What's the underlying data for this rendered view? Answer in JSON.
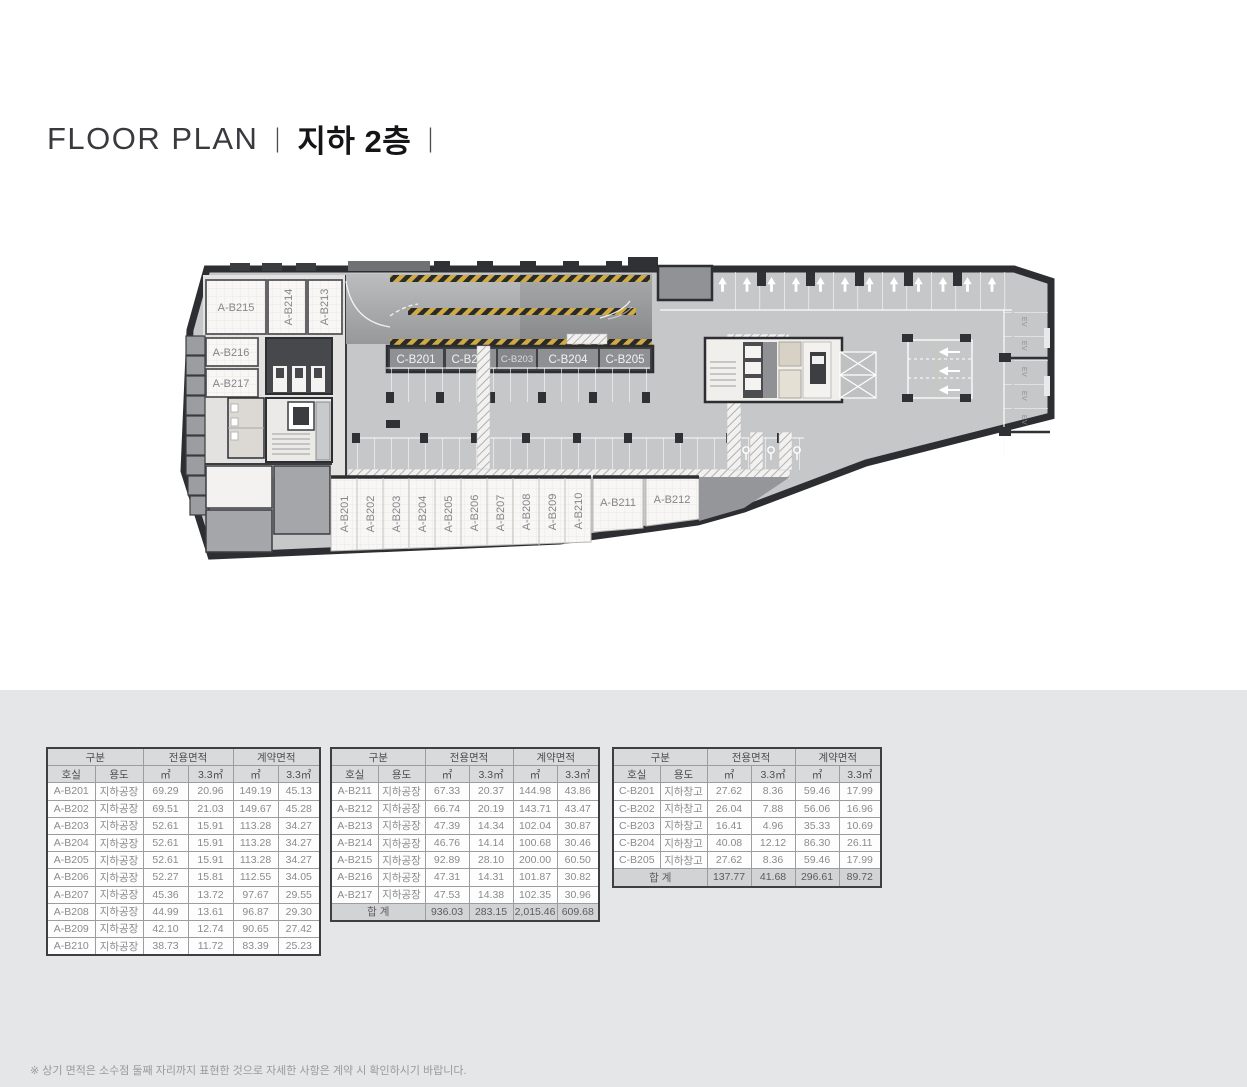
{
  "title": {
    "main": "FLOOR PLAN",
    "sep1": "|",
    "floor": "지하 2층",
    "sep2": "|"
  },
  "plan": {
    "rooms": {
      "a215": "A-B215",
      "a214": "A-B214",
      "a213": "A-B213",
      "a216": "A-B216",
      "a217": "A-B217",
      "a_bottom": [
        "A-B201",
        "A-B202",
        "A-B203",
        "A-B204",
        "A-B205",
        "A-B206",
        "A-B207",
        "A-B208",
        "A-B209",
        "A-B210"
      ],
      "a211": "A-B211",
      "a212": "A-B212",
      "c_units": [
        "C-B201",
        "C-B202",
        "C-B203",
        "C-B204",
        "C-B205"
      ],
      "ev": "EV"
    }
  },
  "table_headers": {
    "group": "구분",
    "room": "호실",
    "use": "용도",
    "exclusive_area": "전용면적",
    "contract_area": "계약면적",
    "m2": "㎡",
    "py": "3.3㎡"
  },
  "tables": [
    {
      "rows": [
        [
          "A-B201",
          "지하공장",
          "69.29",
          "20.96",
          "149.19",
          "45.13"
        ],
        [
          "A-B202",
          "지하공장",
          "69.51",
          "21.03",
          "149.67",
          "45.28"
        ],
        [
          "A-B203",
          "지하공장",
          "52.61",
          "15.91",
          "113.28",
          "34.27"
        ],
        [
          "A-B204",
          "지하공장",
          "52.61",
          "15.91",
          "113.28",
          "34.27"
        ],
        [
          "A-B205",
          "지하공장",
          "52.61",
          "15.91",
          "113.28",
          "34.27"
        ],
        [
          "A-B206",
          "지하공장",
          "52.27",
          "15.81",
          "112.55",
          "34.05"
        ],
        [
          "A-B207",
          "지하공장",
          "45.36",
          "13.72",
          "97.67",
          "29.55"
        ],
        [
          "A-B208",
          "지하공장",
          "44.99",
          "13.61",
          "96.87",
          "29.30"
        ],
        [
          "A-B209",
          "지하공장",
          "42.10",
          "12.74",
          "90.65",
          "27.42"
        ],
        [
          "A-B210",
          "지하공장",
          "38.73",
          "11.72",
          "83.39",
          "25.23"
        ]
      ]
    },
    {
      "rows": [
        [
          "A-B211",
          "지하공장",
          "67.33",
          "20.37",
          "144.98",
          "43.86"
        ],
        [
          "A-B212",
          "지하공장",
          "66.74",
          "20.19",
          "143.71",
          "43.47"
        ],
        [
          "A-B213",
          "지하공장",
          "47.39",
          "14.34",
          "102.04",
          "30.87"
        ],
        [
          "A-B214",
          "지하공장",
          "46.76",
          "14.14",
          "100.68",
          "30.46"
        ],
        [
          "A-B215",
          "지하공장",
          "92.89",
          "28.10",
          "200.00",
          "60.50"
        ],
        [
          "A-B216",
          "지하공장",
          "47.31",
          "14.31",
          "101.87",
          "30.82"
        ],
        [
          "A-B217",
          "지하공장",
          "47.53",
          "14.38",
          "102.35",
          "30.96"
        ]
      ],
      "total": {
        "label": "합 계",
        "values": [
          "936.03",
          "283.15",
          "2,015.46",
          "609.68"
        ]
      }
    },
    {
      "rows": [
        [
          "C-B201",
          "지하창고",
          "27.62",
          "8.36",
          "59.46",
          "17.99"
        ],
        [
          "C-B202",
          "지하창고",
          "26.04",
          "7.88",
          "56.06",
          "16.96"
        ],
        [
          "C-B203",
          "지하창고",
          "16.41",
          "4.96",
          "35.33",
          "10.69"
        ],
        [
          "C-B204",
          "지하창고",
          "40.08",
          "12.12",
          "86.30",
          "26.11"
        ],
        [
          "C-B205",
          "지하창고",
          "27.62",
          "8.36",
          "59.46",
          "17.99"
        ]
      ],
      "total": {
        "label": "합 계",
        "values": [
          "137.77",
          "41.68",
          "296.61",
          "89.72"
        ]
      }
    }
  ],
  "footnote": "※ 상기 면적은 소수점 둘째 자리까지 표현한 것으로 자세한 사항은 계약 시 확인하시기 바랍니다.",
  "colors": {
    "wall": "#2c2e32",
    "floor": "#c6c7c9",
    "hazard_yellow": "#cfaa45",
    "band_dark": "#3e4043"
  }
}
